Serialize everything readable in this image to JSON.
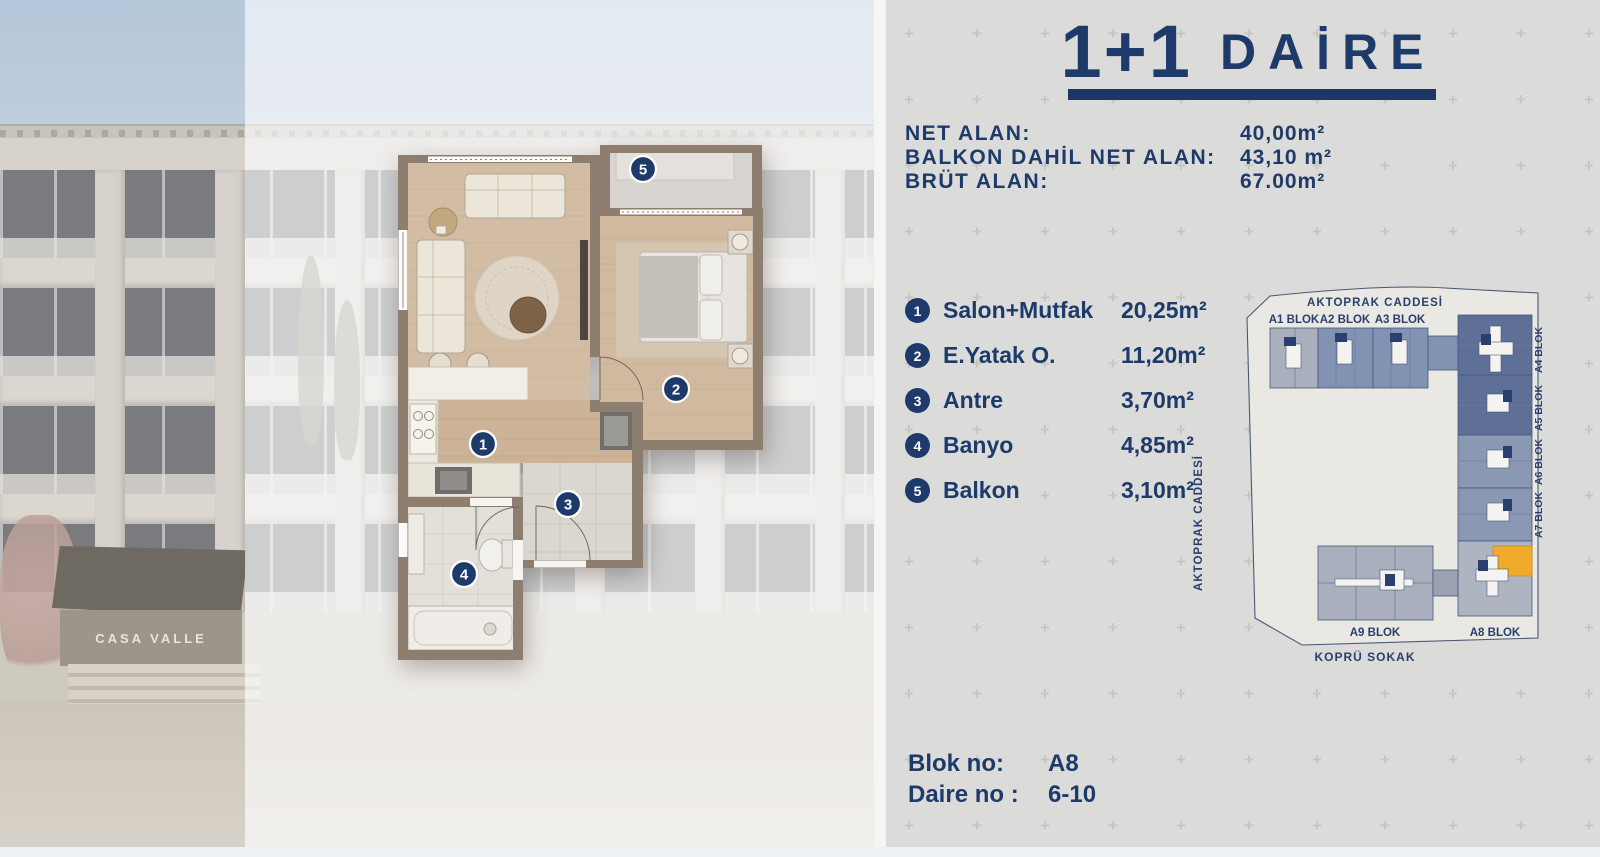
{
  "title": {
    "big": "1+1",
    "word": "DAİRE"
  },
  "stats": [
    {
      "label": "NET ALAN:",
      "value": "40,00m²"
    },
    {
      "label": "BALKON DAHİL NET ALAN:",
      "value": "43,10 m²"
    },
    {
      "label": "BRÜT ALAN:",
      "value": "67.00m²"
    }
  ],
  "rooms": [
    {
      "num": "1",
      "name": "Salon+Mutfak",
      "area": "20,25m²"
    },
    {
      "num": "2",
      "name": "E.Yatak O.",
      "area": "11,20m²"
    },
    {
      "num": "3",
      "name": "Antre",
      "area": "3,70m²"
    },
    {
      "num": "4",
      "name": "Banyo",
      "area": "4,85m²"
    },
    {
      "num": "5",
      "name": "Balkon",
      "area": "3,10m²"
    }
  ],
  "site_plan": {
    "street_top": "AKTOPRAK CADDESİ",
    "street_left": "AKTOPRAK CADDESİ",
    "street_bottom": "KOPRÜ SOKAK",
    "blocks_top": [
      "A1 BLOK",
      "A2 BLOK",
      "A3 BLOK"
    ],
    "blocks_right": [
      "A4 BLOK",
      "A5 BLOK",
      "A6 BLOK",
      "A7 BLOK"
    ],
    "blocks_bottom": [
      "A9 BLOK",
      "A8 BLOK"
    ],
    "highlight_color": "#f0ab2c"
  },
  "unit_info": {
    "blok_label": "Blok no:",
    "blok_value": "A8",
    "daire_label": "Daire no :",
    "daire_value": "6-10"
  },
  "photo": {
    "sign_text": "CASA VALLE"
  },
  "colors": {
    "navy": "#1d3a6a",
    "panel_bg": "#dbdbd9",
    "underline": "#1e3666",
    "orange_unit": "#f0ab2c",
    "wall": "#8d7e6f",
    "wood": "#d2bca4",
    "dark_block": "#5e7097",
    "mid_block": "#8292b2",
    "light_block": "#a9afbc"
  }
}
